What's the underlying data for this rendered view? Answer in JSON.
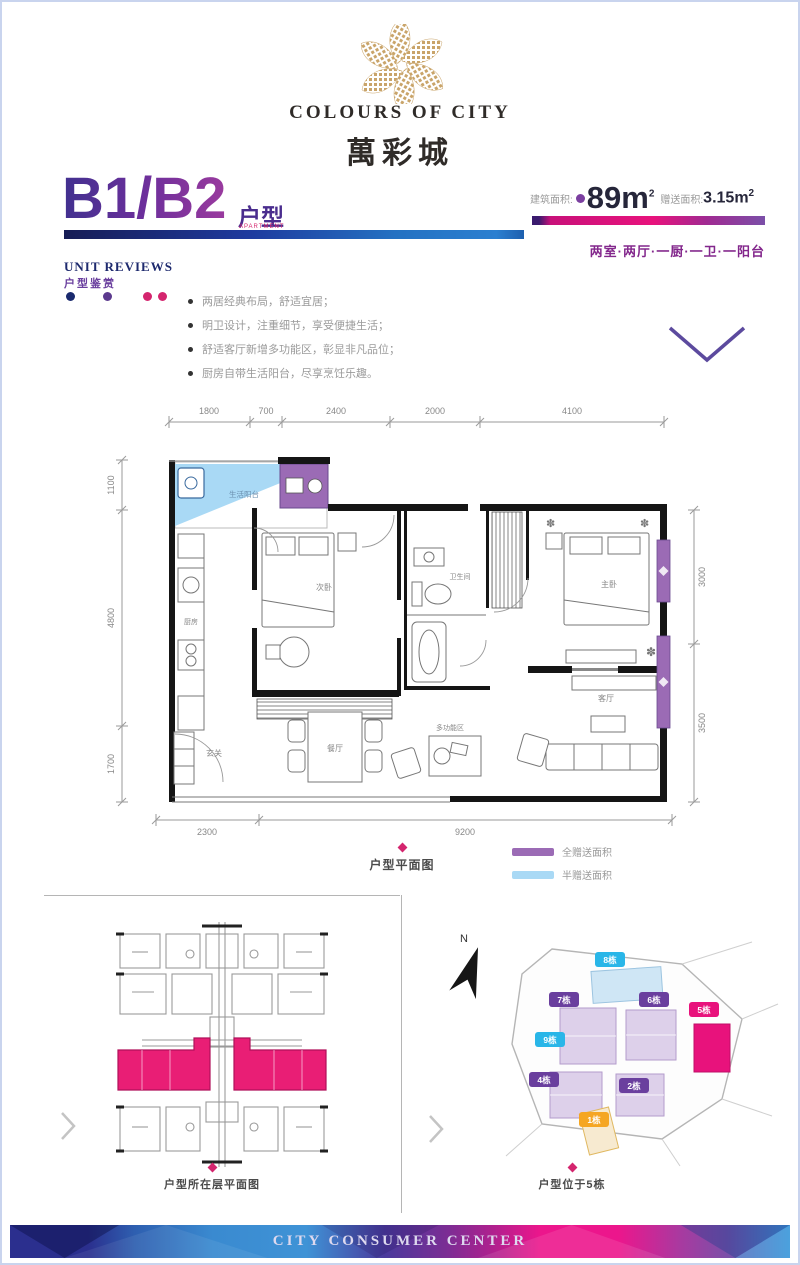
{
  "colors": {
    "accent_purple": "#6a3f9e",
    "accent_magenta": "#e8127c",
    "navy": "#1e2a78",
    "blue": "#2e7fc8",
    "gold": "#c9a469",
    "full_gift_purple": "#9b6bb5",
    "half_gift_blue": "#a9d9f5",
    "highlight_pink": "#e91e75"
  },
  "brand": {
    "logo_en": "COLOURS OF CITY",
    "logo_cn": "萬彩城"
  },
  "header": {
    "unit_code": "B1/B2",
    "unit_suffix": "户型",
    "unit_suffix_note": "APARTMENT",
    "build_area_label": "建筑面积:",
    "build_area_value": "89m",
    "build_area_sup": "2",
    "gift_area_label": "赠送面积:",
    "gift_area_value": "3.15m",
    "gift_area_sup": "2",
    "layout_desc": "两室·两厅·一厨·一卫·一阳台"
  },
  "reviews": {
    "title_en": "UNIT REVIEWS",
    "title_cn": "户型鉴赏",
    "bullets": [
      "两居经典布局，舒适宜居；",
      "明卫设计，注重细节，享受便捷生活；",
      "舒适客厅新增多功能区，彰显非凡品位；",
      "厨房自带生活阳台，尽享烹饪乐趣。"
    ]
  },
  "floorplan": {
    "dims_top": [
      "1800",
      "700",
      "2400",
      "2000",
      "4100"
    ],
    "dims_left": [
      "1100",
      "4800",
      "1700"
    ],
    "dims_right": [
      "3000",
      "3500"
    ],
    "dims_bottom": [
      "2300",
      "9200"
    ],
    "rooms": {
      "life_balcony": "生活阳台",
      "kitchen": "厨房",
      "second_bedroom": "次卧",
      "bathroom": "卫生间",
      "master_bedroom": "主卧",
      "dining": "餐厅",
      "entry": "玄关",
      "multi_zone": "多功能区",
      "living": "客厅"
    },
    "caption": "户型平面图",
    "legend": [
      {
        "label": "全赠送面积",
        "color": "#9b6bb5"
      },
      {
        "label": "半赠送面积",
        "color": "#a9d9f5"
      }
    ]
  },
  "floor_level": {
    "caption": "户型所在层平面图"
  },
  "site_plan": {
    "caption": "户型位于5栋",
    "compass_label": "N",
    "buildings": [
      {
        "label": "8栋",
        "color": "#29b6e8"
      },
      {
        "label": "7栋",
        "color": "#6a3f9e"
      },
      {
        "label": "6栋",
        "color": "#6a3f9e"
      },
      {
        "label": "9栋",
        "color": "#29b6e8"
      },
      {
        "label": "4栋",
        "color": "#6a3f9e"
      },
      {
        "label": "2栋",
        "color": "#6a3f9e"
      },
      {
        "label": "5栋",
        "color": "#e8127c"
      },
      {
        "label": "1栋",
        "color": "#f5a623"
      }
    ]
  },
  "footer": {
    "text": "CITY CONSUMER CENTER"
  }
}
